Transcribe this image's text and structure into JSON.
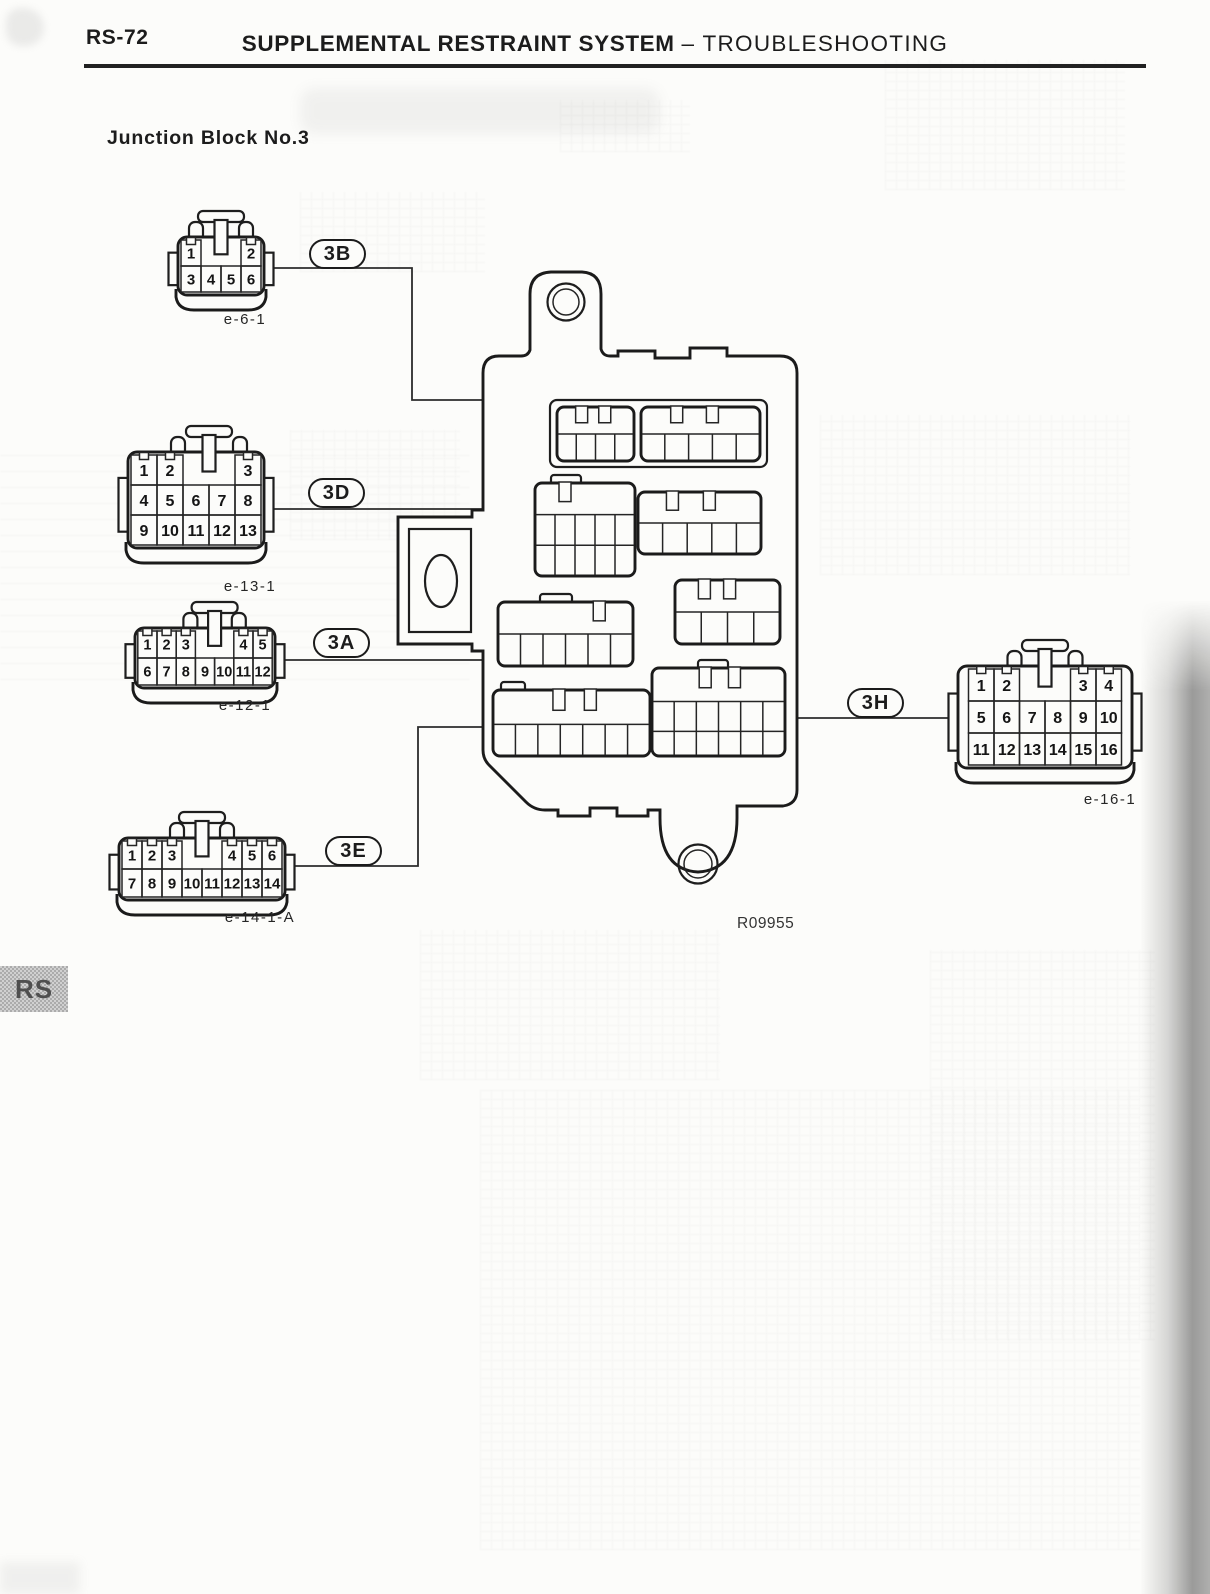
{
  "page": {
    "code": "RS-72",
    "title": "SUPPLEMENTAL RESTRAINT SYSTEM",
    "subtitle": "– TROUBLESHOOTING",
    "section": "Junction Block No.3",
    "figure_code": "R09955",
    "side_tab": "RS"
  },
  "connectors": [
    {
      "id": "e-6-1",
      "callout": "3B",
      "rows": [
        [
          "1",
          "",
          "",
          "2"
        ],
        [
          "3",
          "4",
          "5",
          "6"
        ]
      ]
    },
    {
      "id": "e-13-1",
      "callout": "3D",
      "rows": [
        [
          "1",
          "2",
          "",
          "",
          "3"
        ],
        [
          "4",
          "5",
          "6",
          "7",
          "8"
        ],
        [
          "9",
          "10",
          "11",
          "12",
          "13"
        ]
      ]
    },
    {
      "id": "e-12-1",
      "callout": "3A",
      "rows": [
        [
          "1",
          "2",
          "3",
          "",
          "",
          "4",
          "5"
        ],
        [
          "6",
          "7",
          "8",
          "9",
          "10",
          "11",
          "12"
        ]
      ]
    },
    {
      "id": "e-14-1-A",
      "callout": "3E",
      "rows": [
        [
          "1",
          "2",
          "3",
          "",
          "",
          "4",
          "5",
          "6"
        ],
        [
          "7",
          "8",
          "9",
          "10",
          "11",
          "12",
          "13",
          "14"
        ]
      ]
    },
    {
      "id": "e-16-1",
      "callout": "3H",
      "rows": [
        [
          "1",
          "2",
          "",
          "",
          "3",
          "4"
        ],
        [
          "5",
          "6",
          "7",
          "8",
          "9",
          "10"
        ],
        [
          "11",
          "12",
          "13",
          "14",
          "15",
          "16"
        ]
      ]
    }
  ],
  "colors": {
    "ink": "#1c1c1c",
    "paper": "#fcfcfa",
    "shadow": "#5e5e5e"
  }
}
